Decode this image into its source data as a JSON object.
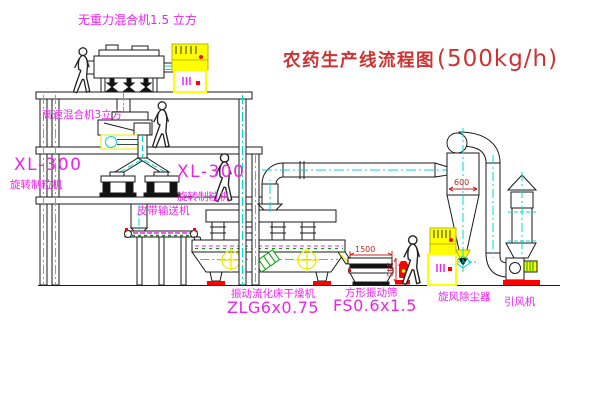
{
  "title": {
    "name": "农药生产线流程图",
    "capacity": "(500kg/h)"
  },
  "equipment": {
    "zero_gravity_mixer": {
      "label": "无重力混合机1.5 立方"
    },
    "high_speed_mixer": {
      "label": "高速混合机3立方"
    },
    "granulator_left": {
      "model": "XL-300",
      "name": "旋转制粒机"
    },
    "granulator_right": {
      "model": "XL-300",
      "name": "旋转制粒机"
    },
    "belt_conveyor": {
      "label": "皮带输送机"
    },
    "dryer": {
      "name": "振动流化床干燥机",
      "model": "ZLG6x0.75"
    },
    "sieve": {
      "name": "方形振动筛",
      "model": "FS0.6x1.5"
    },
    "cyclone": {
      "name": "旋风除尘器"
    },
    "fan": {
      "name": "引风机"
    }
  },
  "dimensions": {
    "cyclone_width": "600",
    "sieve_length": "1500",
    "sieve_height": "340"
  },
  "colors": {
    "label_magenta": "#ee22ee",
    "title_red": "#cc3333",
    "centerline_cyan": "#00d8d8",
    "highlight_yellow": "#ffff00",
    "accent_red": "#ff0000",
    "accent_green": "#00a000",
    "line_black": "#1a1a1a"
  }
}
